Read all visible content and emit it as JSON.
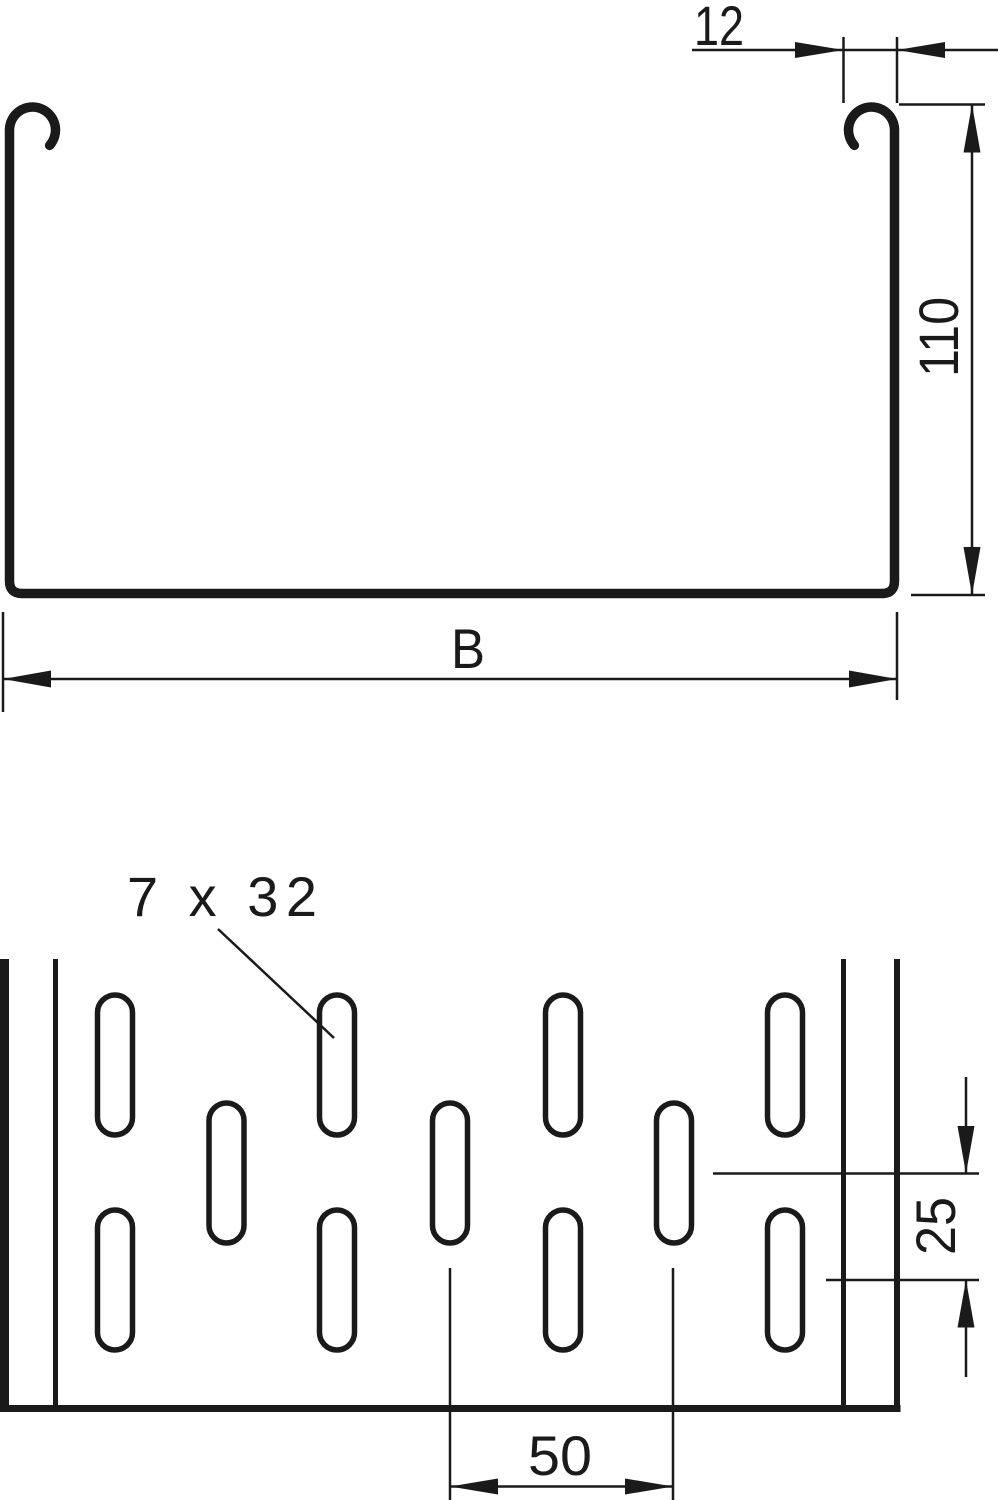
{
  "drawing": {
    "background": "#ffffff",
    "line_color": "#1a1a1a",
    "cross_section_view": {
      "flange_width_dim": {
        "label": "12"
      },
      "height_dim": {
        "label": "110"
      },
      "width_dim": {
        "label": "B"
      }
    },
    "perforation_view": {
      "slot_size_label": "7 x 32",
      "row_offset_dim": {
        "label": "25"
      },
      "slot_pitch_dim": {
        "label": "50"
      }
    }
  }
}
